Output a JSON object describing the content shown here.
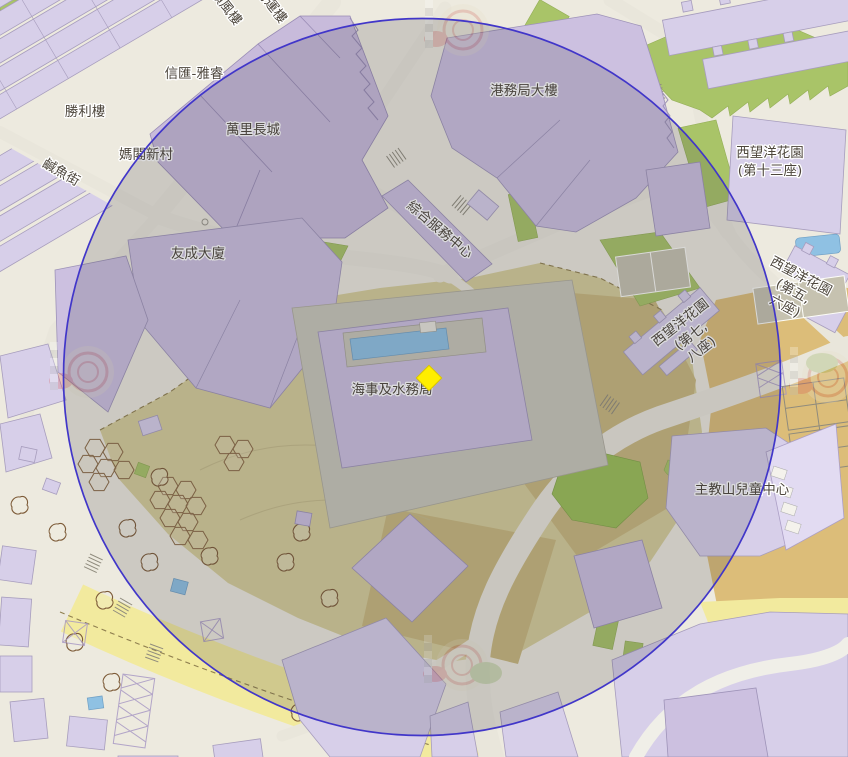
{
  "map": {
    "labels": [
      {
        "id": "shun-fung-lau",
        "text": "順風樓"
      },
      {
        "id": "sing-wan-lau",
        "text": "勝運樓"
      },
      {
        "id": "shun-wui-nga-yui",
        "text": "信匯-雅睿"
      },
      {
        "id": "sing-lei-lau",
        "text": "勝利樓"
      },
      {
        "id": "man-lei-cheung-sing",
        "text": "萬里長城"
      },
      {
        "id": "ma-kok-san-chuen",
        "text": "媽閣新村"
      },
      {
        "id": "kong-mou-kuk-tai-lau",
        "text": "港務局大樓"
      },
      {
        "id": "yau-sing-tai-ha",
        "text": "友成大廈"
      },
      {
        "id": "hoi-si-kap-seoi-mou-kuk",
        "text": "海事及水務局"
      },
      {
        "id": "chu-kau-san-children-centre",
        "text": "主教山兒童中心"
      },
      {
        "id": "sai-mong-yeung-13",
        "lines": [
          "西望洋花園",
          "(第十三座)"
        ]
      },
      {
        "id": "sai-mong-yeung-5-6",
        "lines": [
          "西望洋花園",
          "(第五,",
          "六座)"
        ]
      },
      {
        "id": "sai-mong-yeung-7-8",
        "lines": [
          "西望洋花園",
          "(第七,",
          "八座)"
        ]
      },
      {
        "id": "chung-hap-fuk-mou-chung-sam",
        "text": "綜合服務中心"
      }
    ],
    "street_labels": [
      {
        "id": "ham-yu-street",
        "text": "鹹魚街"
      }
    ],
    "marker": {
      "name": "selected-location-marker",
      "shape": "diamond",
      "color": "#ffee00",
      "edge": "#d8c400"
    },
    "selection_circle": {
      "name": "radius-overlay",
      "stroke_color": "#4136c9",
      "fill_color": "rgba(58,58,66,0.18)"
    },
    "palette": {
      "base": "#edeadf",
      "building": "#d7cfe9",
      "building_dark": "#c8bbdb",
      "terrain_khaki": "#d6cd9a",
      "terrain_tan": "#c9b87e",
      "terrain_orange": "#dcbd79",
      "terrain_yellow": "#f2ea9e",
      "vegetation": "#a9c468",
      "water": "#8fc1e3",
      "road": "#e9e6db"
    }
  }
}
